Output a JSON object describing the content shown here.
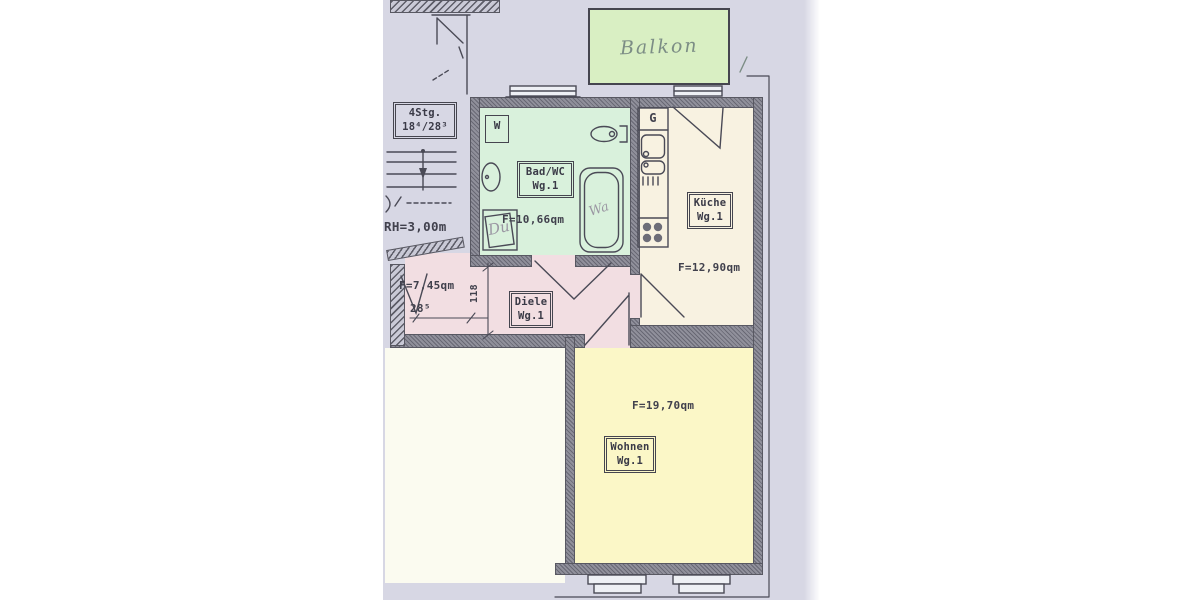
{
  "scan": {
    "stairwell": {
      "stairs_box_line1": "4Stg.",
      "stairs_box_line2": "18⁴/28³",
      "room_height_label": "RH=3,00m"
    },
    "balcony": {
      "label": "Balkon"
    },
    "bath": {
      "name": "Bad/WC",
      "unit": "Wg.1",
      "area": "F=10,66qm",
      "washer_label": "W",
      "shower_label": "Du",
      "tub_label": "Wa"
    },
    "kitchen": {
      "name": "Küche",
      "unit": "Wg.1",
      "area": "F=12,90qm",
      "stove_label": "G"
    },
    "hall": {
      "name": "Diele",
      "unit": "Wg.1",
      "area": "F=7,45qm",
      "width_dim": "118",
      "step_dim": "28⁵"
    },
    "living": {
      "name": "Wohnen",
      "unit": "Wg.1",
      "area": "F=19,70qm"
    },
    "colors": {
      "balcony": "#d9efc3",
      "bath": "#d9f1dc",
      "kitchen": "#f8f2e1",
      "hall": "#f2dee2",
      "living": "#fbf7c7",
      "blank_paper": "#fbfbf0",
      "paper": "#d7d7e4",
      "line": "#4a4a56"
    }
  }
}
